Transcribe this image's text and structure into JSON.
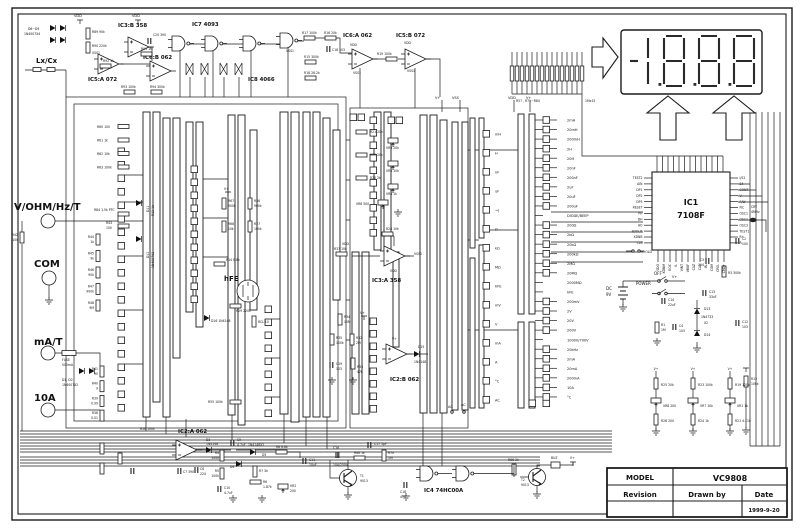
{
  "title_block": {
    "model_label": "MODEL",
    "model_value": "VC9808",
    "revision_label": "Revision",
    "drawn_by_label": "Drawn by",
    "date_label": "Date",
    "date_value": "1999-9-20"
  },
  "display": {
    "reading": "-1888"
  },
  "res_array": {
    "label": "R57 , R71~R84",
    "mult": "1Mx15"
  },
  "common": {
    "vdd": "VDD",
    "vss1": "VSS1",
    "vss": "VSS",
    "vplus": "V+",
    "ac": "AC"
  },
  "ic1": {
    "name": "IC1",
    "part": "7108F",
    "left_pins": [
      "TEST2",
      "AIN",
      "DP1",
      "DP2",
      "DP3",
      "RESET",
      "PH",
      "DH",
      "HO",
      "SDOUT",
      "XDNB",
      "CLK"
    ],
    "right_pins": [
      "I/S1",
      "S4",
      "CONT",
      "V-",
      "F/W",
      "NC",
      "OSC1",
      "OSC2",
      "OSC3",
      "TEST1",
      "R+",
      "R-"
    ],
    "bottom_pins": [
      "SDO",
      "KDNM",
      "EOC",
      "V-",
      "VINT",
      "VBUF",
      "CAZ",
      "CA2",
      "IN-",
      "COM",
      "CRD-",
      "CRD+"
    ]
  },
  "right": {
    "cry1": "CRY",
    "cry2": "4MHz",
    "c2a": "C2",
    "c2b": "100",
    "c3a": "C3",
    "c3b": "104",
    "r3": "R3 300k",
    "c13a": "C13",
    "c13b": "33uF",
    "c14a": "C14",
    "c14b": "22uF",
    "power": "POWER",
    "off": "OFF",
    "dc": "DC",
    "nine": "9V",
    "hold": "HOLD",
    "d13": "D13",
    "zen": "1N4733",
    "x2": "X2",
    "d14": "D14",
    "c12a": "C12",
    "c12b": "103",
    "r1a": "R1",
    "r1b": "1M",
    "c4a": "C4",
    "c4b": "103",
    "r12a": "R12",
    "r12b": "100k",
    "chains": [
      {
        "v": "V+",
        "a": "R25 20k",
        "b": "VR8 200",
        "c": "R26 200"
      },
      {
        "v": "V+",
        "a": "R23 100k",
        "b": "VR7 10k",
        "c": "R24 1k"
      },
      {
        "v": "V+",
        "a": "R19 120k",
        "b": "VR1 1k",
        "c": "R21 4.11k"
      }
    ]
  },
  "ranges": [
    {
      "t": "2mH",
      "sq": true
    },
    {
      "t": "20mH",
      "sq": true
    },
    {
      "t": "200mH",
      "sq": true
    },
    {
      "t": "2H",
      "sq": true
    },
    {
      "t": "20H",
      "sq": true
    },
    {
      "t": "20nF",
      "sq": true
    },
    {
      "t": "200nF",
      "sq": true
    },
    {
      "t": "2uF",
      "sq": true
    },
    {
      "t": "20uF",
      "sq": true
    },
    {
      "t": "200uF",
      "sq": true
    },
    {
      "t": "DIODE/BEEP",
      "sq": false
    },
    {
      "t": "200Ω",
      "sq": true
    },
    {
      "t": "2kΩ",
      "sq": true
    },
    {
      "t": "20kΩ",
      "sq": true
    },
    {
      "t": "200kΩ",
      "sq": true
    },
    {
      "t": "2MΩ",
      "sq": true
    },
    {
      "t": "20MΩ",
      "sq": true
    },
    {
      "t": "2000MΩ",
      "sq": false
    },
    {
      "t": "hFE",
      "sq": false
    },
    {
      "t": "200mV",
      "sq": true
    },
    {
      "t": "2V",
      "sq": true
    },
    {
      "t": "20V",
      "sq": true
    },
    {
      "t": "200V",
      "sq": true
    },
    {
      "t": "1000V/700V",
      "sq": false
    },
    {
      "t": "20kHz",
      "sq": true
    },
    {
      "t": "2mA",
      "sq": true
    },
    {
      "t": "20mA",
      "sq": true
    },
    {
      "t": "200mA",
      "sq": true
    },
    {
      "t": "10A",
      "sq": true
    },
    {
      "t": "°C",
      "sq": true
    }
  ],
  "wafer_units": [
    "mH",
    "H",
    "nF",
    "uF",
    "→|",
    "Ω",
    "kΩ",
    "MΩ",
    "hFE",
    "mV",
    "V",
    "mA",
    "A",
    "°C",
    "AC"
  ],
  "osc": {
    "d69a": "D6~D9",
    "d69b": "1N4007X4",
    "lxcx": "Lx/Cx",
    "r89": "R89 90k",
    "r90": "R90 220k",
    "r92": "R92 1k",
    "ic5a": "IC5:A 072",
    "ic3b": "IC3:B 358",
    "ic6b": "IC6:B 062",
    "ic7": "IC7 4093",
    "ic8": "IC8 4066",
    "r91": "R91 1M",
    "c20": "C20 390",
    "r93": "R93 100k",
    "r94": "R94 300k",
    "ic6a": "IC6:A 062",
    "ic5b": "IC5:B 072",
    "r17": "R17 100k",
    "r16": "R16 20k",
    "c15": "C18 103",
    "r15": "R15 300k",
    "r18": "R18 28.2k",
    "r19": "R19 100k"
  },
  "inputs": {
    "vohm": "V/OHM/Hz/T",
    "com": "COM",
    "mat": "mA/T",
    "tena": "10A",
    "r84": "R84 1.5k PTC",
    "r43a": "R43",
    "r43b": "100",
    "r42a": "R42",
    "r42b": "10k",
    "d11": "D11",
    "r12v": "R12 1k",
    "d12": "D12",
    "d12v": "1N4007X2",
    "vohm_res": [
      {
        "a": "R44",
        "b": "1k"
      },
      {
        "a": "R45",
        "b": "9k"
      },
      {
        "a": "R46",
        "b": "90k"
      },
      {
        "a": "R47",
        "b": "900k"
      },
      {
        "a": "R48",
        "b": "9M"
      }
    ],
    "r60_group": [
      "R60 100",
      "R61 1k",
      "R62 10k",
      "R63 100k"
    ],
    "fuse1": "FUSE",
    "fuse2": "500mA",
    "d12lbl": "D1, D2",
    "d12lblb": "1N4007X2",
    "shunts": [
      {
        "a": "R41",
        "b": "90"
      },
      {
        "a": "R40",
        "b": "9"
      },
      {
        "a": "R39",
        "b": "0.99"
      },
      {
        "a": "R38",
        "b": "0.01"
      }
    ]
  },
  "trim_mid": [
    {
      "r": "R21 20k",
      "vr": "VR3 20k"
    },
    {
      "r": "R22 20k",
      "vr": "VR5 10k"
    },
    {
      "r": "R20 2k",
      "vr": "VR4 1k"
    }
  ],
  "vr6": "VR6 500",
  "hfe": {
    "r67a": "R67",
    "r67b": "900k",
    "r68a": "R68",
    "r68b": "10k",
    "r36a": "R36",
    "r36b": "900k",
    "r27a": "R27",
    "r27b": "100k",
    "r14": "R14 8.8k",
    "r29": "R29 220k",
    "rcl": "RCL 10",
    "d16": "D16 1N4148",
    "hfe": "hFE"
  },
  "amps": {
    "ic3a": "IC3:A 358",
    "r28": "R28 10k",
    "r37": "R37 10k",
    "ic2b": "IC2:B 062",
    "r34a": "R34",
    "r34b": "10M",
    "r35a": "R35",
    "r35b": "100k",
    "r32a": "R32",
    "r32b": "2M",
    "c19a": "C19",
    "c19b": "103",
    "r33a": "R33",
    "r33b": "47k",
    "d15": "D15",
    "d15v": "1N4148"
  },
  "bottom": {
    "ic2a": "IC2:A 062",
    "r56": "R56 100k",
    "r55": "R55 100k",
    "d3a": "D3",
    "d3b": "1N4148",
    "c9a": "C9",
    "c9b": "4.7uF",
    "dx2": "1N4148X2",
    "d5": "D5",
    "d4": "D4",
    "r4a": "R4",
    "r4b": "100k",
    "r5a": "R5",
    "r5b": "100k",
    "c7": "C7 390",
    "c8a": "C8",
    "c8b": "224",
    "r7": "R7 3k",
    "r6a": "R6",
    "r6b": "1.87k",
    "vr2a": "VR2",
    "vr2b": "200",
    "c10a": "C10",
    "c10b": "4.7uF",
    "c11a": "C11",
    "c11b": "10uF",
    "r8": "R8 6.8k",
    "c16a": "C16",
    "c16b": "104/250V",
    "r66": "R66 1k",
    "t1a": "T1",
    "t1b": "9013",
    "c17": "C17 5pF",
    "r70a": "R70",
    "r70b": "1M",
    "ic4": "IC4 74HC00A",
    "c18a": "C18",
    "c18b": "473",
    "r68": "R68 2k",
    "t2a": "T2",
    "t2b": "9013",
    "buz": "BUZ"
  }
}
